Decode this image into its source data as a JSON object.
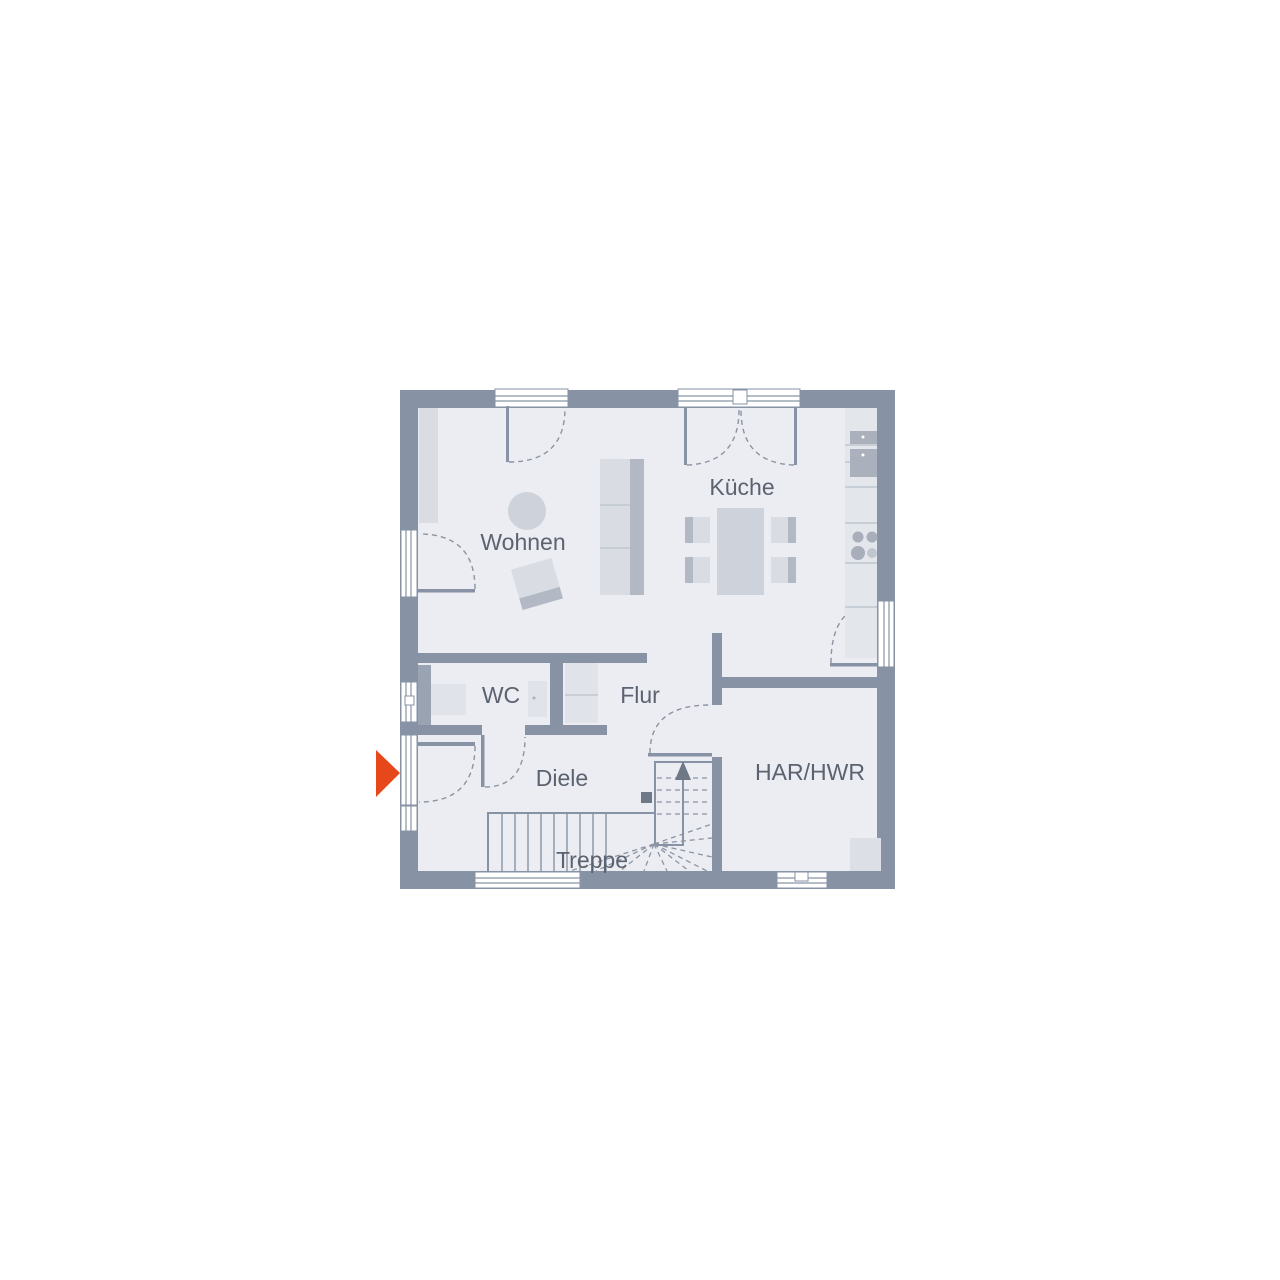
{
  "diagram": {
    "type": "floor-plan",
    "floor": "ground-floor"
  },
  "rooms": {
    "wohnen": {
      "label": "Wohnen"
    },
    "kueche": {
      "label": "Küche"
    },
    "wc": {
      "label": "WC"
    },
    "flur": {
      "label": "Flur"
    },
    "diele": {
      "label": "Diele"
    },
    "treppe": {
      "label": "Treppe"
    },
    "har_hwr": {
      "label": "HAR/HWR"
    }
  },
  "colors": {
    "background": "#ffffff",
    "wall": "#8793a4",
    "floor": "#ebedf2",
    "furniture_light": "#d9dce3",
    "furniture_dark": "#b2b9c4",
    "kitchen_counter": "#e3e6eb",
    "appliance": "#aab1bd",
    "dashed_line": "#8b94a3",
    "label_text": "#5c6370",
    "entrance_arrow": "#e7481b",
    "stair_marker": "#6f7887"
  },
  "markers": {
    "entrance": {
      "icon": "entrance-arrow",
      "direction": "right"
    },
    "stair_direction": {
      "icon": "up-arrow"
    }
  }
}
